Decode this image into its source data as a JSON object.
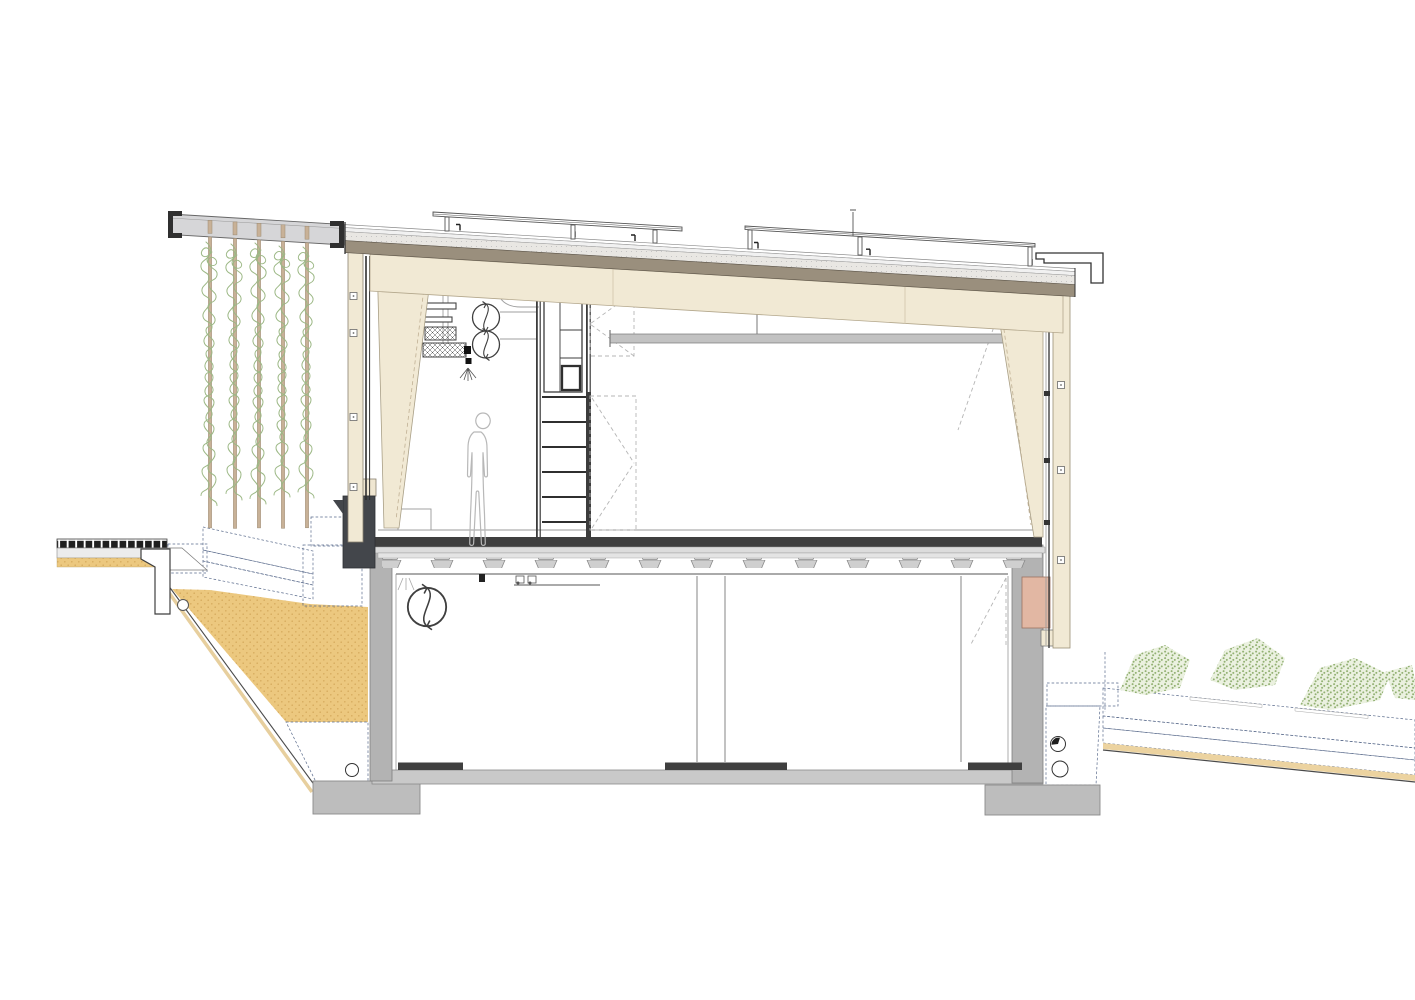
{
  "scene": {
    "type": "architectural-cross-section",
    "components": [
      "pergola-canopy-beam",
      "trellis-posts",
      "climbing-vines",
      "left-walkway",
      "planter-bed",
      "concrete-retaining-wall",
      "sloped-roof",
      "metal-roofing",
      "insulation-layer",
      "timber-structure-layer",
      "solar-collectors",
      "parapet-cap",
      "timber-left-wall",
      "glazing",
      "tapered-glulam-columns",
      "upper-hall",
      "ventilation-unit",
      "supply-ducts",
      "equipment-shelves",
      "ceiling-beam",
      "human-figure",
      "stair",
      "cabinet-shaft",
      "door-swings",
      "ribbed-concrete-slab",
      "floor-finish",
      "concrete-upstand",
      "basement",
      "basement-fan",
      "partitions",
      "floor-strips",
      "basement-slab",
      "footings",
      "sand-fill",
      "drainage-gravel",
      "rubble-stones",
      "drain-pipes",
      "right-terrain-green-landscape",
      "vegetation-clusters",
      "pink-wall-panel",
      "timber-cladding-board",
      "corner-duct"
    ]
  },
  "palette": {
    "paper": "#ffffff",
    "outline": "#4a4a4a",
    "cream": "#f1e9d4",
    "cream_edge": "#b3a78c",
    "roof_taupe": "#9a8f7d",
    "insulation_gray": "#e9e7e3",
    "canopy_gray": "#d6d6d8",
    "charcoal": "#43464b",
    "pink_panel": "#e2b7a3",
    "sand": "#ecc87f",
    "sand_dot": "#d6ab5e",
    "sand_pale": "#ecd3a0",
    "beam_gray": "#c2c2c2",
    "floor_dark": "#3f3f3f",
    "concrete_wall": "#b3b3b3",
    "footing_gray": "#bdbdbd",
    "slab_gray": "#c9c9c9",
    "screed_gray": "#dcdcdc",
    "rib_gray": "#cfcfcf",
    "post_tan": "#c8b197",
    "vine_green": "#9cb885",
    "planter_green": "#e2edd4",
    "planter_line": "#a9c48b",
    "veg_bg": "#ebf1e0",
    "veg_dot": "#93b173",
    "gravel_blue": "#9aa4b6",
    "dash_blue": "#5a6b8c",
    "figure_gray": "#b8b8b8"
  }
}
